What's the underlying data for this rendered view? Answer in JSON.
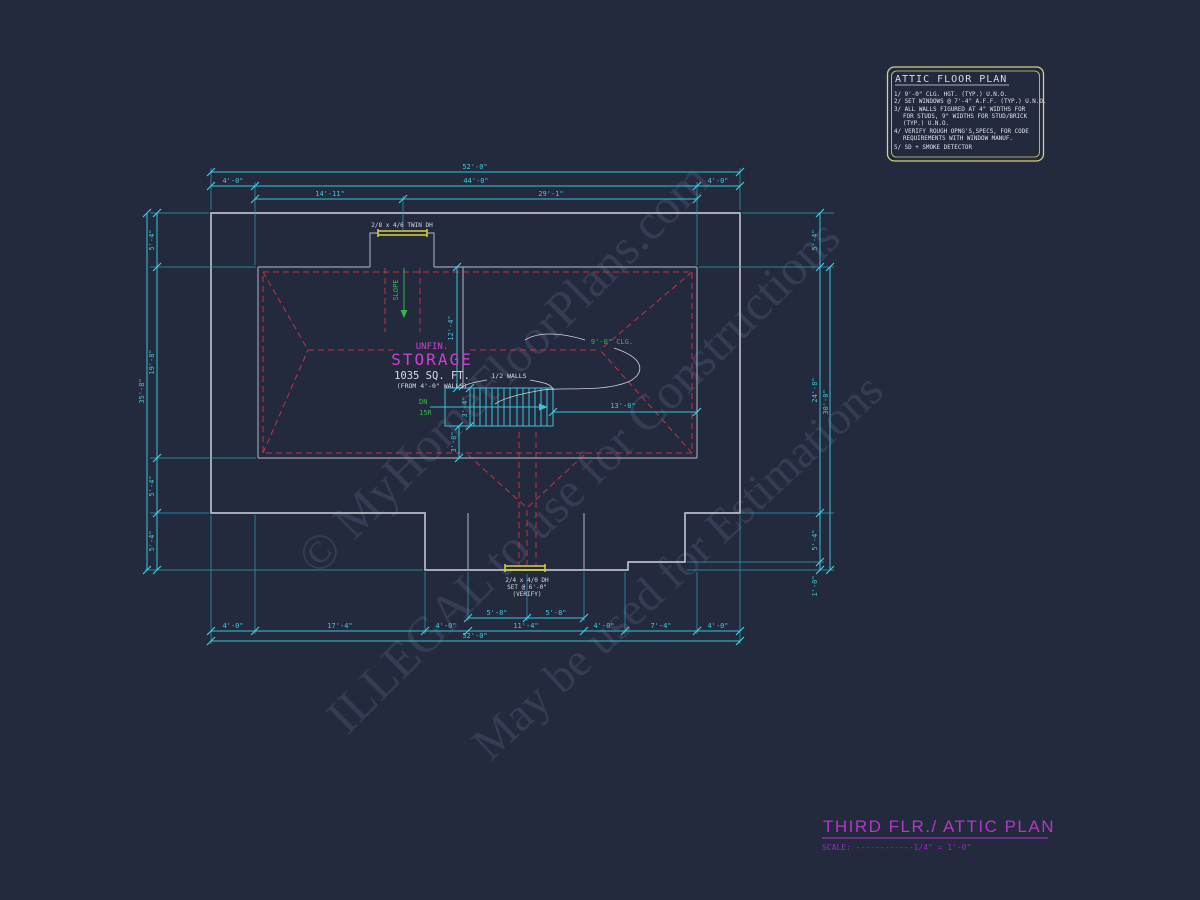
{
  "watermarks": {
    "line1": "© MyHomeFloorPlans.com",
    "line2": "ILLEGAL to use for Constructions",
    "line3": "May be used for Estimations"
  },
  "notes_box": {
    "title": "ATTIC FLOOR PLAN",
    "lines": [
      "1/ 9'-0\" CLG. HGT. (TYP.) U.N.O.",
      "2/ SET WINDOWS @ 7'-4\" A.F.F. (TYP.) U.N.O.",
      "3/ ALL WALLS FIGURED AT 4\" WIDTHS FOR",
      "FOR STUDS, 9\" WIDTHS FOR STUD/BRICK",
      "(TYP.) U.N.O.",
      "4/ VERIFY ROUGH OPNG'S,SPECS, FOR CODE",
      "REQUIREMENTS WITH WINDOW MANUF.",
      "5/ SD + SMOKE DETECTOR"
    ]
  },
  "title_block": {
    "title": "THIRD FLR./ ATTIC PLAN",
    "scale": "SCALE: ------------1/4\" = 1'-0\""
  },
  "room": {
    "line1": "UNFIN.",
    "line2": "STORAGE",
    "area": "1035 SQ. FT.",
    "area_note": "(FROM 4'-0\" WALLS)"
  },
  "labels": {
    "twin_window": "2/8 x 4/6 TWIN DH",
    "slope": "SLOPE",
    "ceiling": "9'-0\" CLG.",
    "half_walls": "1/2 WALLS",
    "down": "DN",
    "risers": "15R",
    "bottom_window_1": "2/4 x 4/0 DH",
    "bottom_window_2": "SET @ 6'-0\"",
    "bottom_window_3": "(VERIFY)"
  },
  "dims": {
    "top_overall": "52'-0\"",
    "top_left_4": "4'-0\"",
    "top_44": "44'-0\"",
    "top_right_4": "4'-0\"",
    "top_14_11": "14'-11\"",
    "top_29_1": "29'-1\"",
    "left_5_4_a": "5'-4\"",
    "left_19_8": "19'-8\"",
    "left_5_4_b": "5'-4\"",
    "left_5_4_c": "5'-4\"",
    "left_overall": "35'-8\"",
    "right_5_4_a": "5'-4\"",
    "right_24_8": "24'-8\"",
    "right_30_0": "30'-0\"",
    "right_5_4_b": "5'-4\"",
    "right_1_0": "1'-0\"",
    "bottom_5_8_a": "5'-8\"",
    "bottom_5_8_b": "5'-8\"",
    "bottom_4_a": "4'-0\"",
    "bottom_17_4": "17'-4\"",
    "bottom_4_b": "4'-0\"",
    "bottom_11_4": "11'-4\"",
    "bottom_4_c": "4'-0\"",
    "bottom_7_4": "7'-4\"",
    "bottom_4_d": "4'-0\"",
    "bottom_overall": "52'-0\"",
    "int_12_4": "12'-4\"",
    "int_3_4": "3'-4\"",
    "int_3_8": "3'-8\"",
    "int_13_0": "13'-0\""
  },
  "colors": {
    "background": "#232a3e",
    "dimension_cyan": "#38c4d8",
    "wall_gray": "#b9bdc9",
    "roof_dashed_red": "#c23344",
    "window_yellow": "#d9d23a",
    "annotation_green": "#3bb24a",
    "room_magenta": "#cf3fd4",
    "title_magenta": "#b337c9",
    "scale_purple": "#8e2fb8",
    "watermark": "#9aa5cf"
  }
}
